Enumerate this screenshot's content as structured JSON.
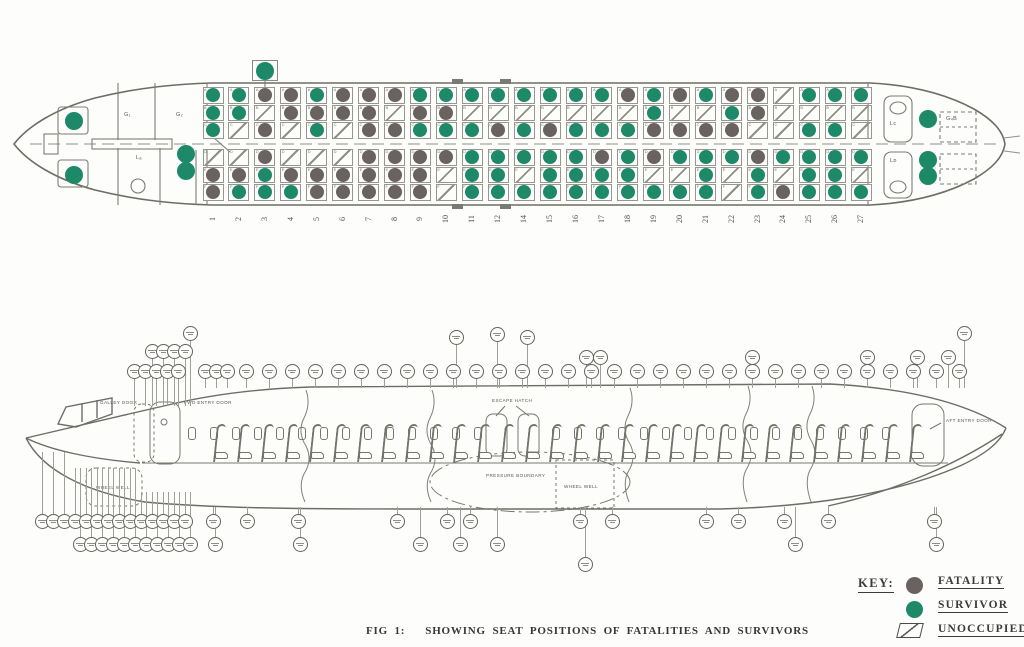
{
  "figure": {
    "label": "FIG 1:",
    "caption": "SHOWING SEAT POSITIONS OF FATALITIES AND SURVIVORS"
  },
  "key": {
    "heading": "KEY:",
    "items": [
      {
        "id": "fatality",
        "label": "FATALITY",
        "shape": "circle",
        "color": "#6a6261"
      },
      {
        "id": "survivor",
        "label": "SURVIVOR",
        "shape": "circle",
        "color": "#1e8968"
      },
      {
        "id": "unoccupied",
        "label": "UNOCCUPIED",
        "shape": "hatched-square",
        "color": "#5a5a5a"
      }
    ]
  },
  "plan_view": {
    "legend_states": {
      "S": "survivor",
      "F": "fatality",
      "U": "unoccupied"
    },
    "seat_letters": {
      "top": [
        "A",
        "B",
        "C"
      ],
      "bottom": [
        "D",
        "E",
        "F"
      ]
    },
    "cabin_labels": {
      "galley_1": "G₁",
      "galley_2": "G₂",
      "fwd_lavatory": "Lₐ",
      "closet": "C",
      "aft_lavatory_left": "Lᴄ",
      "aft_lavatory_right": "Lᴅ",
      "aft_galley": "G₄B"
    },
    "rows": [
      {
        "n": "1",
        "top": "SSS",
        "bottom": "UFF"
      },
      {
        "n": "2",
        "top": "SSU",
        "bottom": "UFS"
      },
      {
        "n": "3",
        "top": "FUF",
        "bottom": "FSS"
      },
      {
        "n": "4",
        "top": "FFU",
        "bottom": "UFS"
      },
      {
        "n": "5",
        "top": "SFS",
        "bottom": "UFF"
      },
      {
        "n": "6",
        "top": "FFU",
        "bottom": "UFF"
      },
      {
        "n": "7",
        "top": "FFF",
        "bottom": "FFF"
      },
      {
        "n": "8",
        "top": "FUF",
        "bottom": "FFF"
      },
      {
        "n": "9",
        "top": "SFS",
        "bottom": "FFF"
      },
      {
        "n": "10",
        "top": "SFS",
        "bottom": "FUU"
      },
      {
        "n": "11",
        "top": "SUS",
        "bottom": "SSS"
      },
      {
        "n": "12",
        "top": "SUF",
        "bottom": "SSS"
      },
      {
        "n": "14",
        "top": "SUS",
        "bottom": "SUS"
      },
      {
        "n": "15",
        "top": "SUF",
        "bottom": "SSS"
      },
      {
        "n": "16",
        "top": "SUS",
        "bottom": "SSS"
      },
      {
        "n": "17",
        "top": "SUS",
        "bottom": "FSS"
      },
      {
        "n": "18",
        "top": "FUS",
        "bottom": "SSS"
      },
      {
        "n": "19",
        "top": "SSF",
        "bottom": "FUS"
      },
      {
        "n": "20",
        "top": "FUF",
        "bottom": "SUS"
      },
      {
        "n": "21",
        "top": "SUF",
        "bottom": "SSS"
      },
      {
        "n": "22",
        "top": "FSF",
        "bottom": "SUU"
      },
      {
        "n": "23",
        "top": "FFU",
        "bottom": "FSS"
      },
      {
        "n": "24",
        "top": "UUU",
        "bottom": "SUF"
      },
      {
        "n": "25",
        "top": "SUS",
        "bottom": "SSS"
      },
      {
        "n": "26",
        "top": "SUS",
        "bottom": "SSS"
      },
      {
        "n": "27",
        "top": "SUU",
        "bottom": "SUS"
      }
    ],
    "jumpseats": [
      {
        "name": "cockpit-captain",
        "state": "S",
        "x": 74,
        "y": 121
      },
      {
        "name": "cockpit-first-officer",
        "state": "S",
        "x": 74,
        "y": 175
      },
      {
        "name": "fwd-jumpseat-1",
        "state": "S",
        "x": 186,
        "y": 154
      },
      {
        "name": "fwd-jumpseat-2",
        "state": "S",
        "x": 186,
        "y": 171
      },
      {
        "name": "aft-jumpseat-left",
        "state": "S",
        "x": 928,
        "y": 119
      },
      {
        "name": "aft-jumpseat-right-1",
        "state": "S",
        "x": 928,
        "y": 160
      },
      {
        "name": "aft-jumpseat-right-2",
        "state": "S",
        "x": 928,
        "y": 176
      }
    ],
    "annotation_seat": {
      "row": "3",
      "side": "top",
      "state": "S"
    }
  },
  "side_view": {
    "labels": {
      "galley_door": "GALLEY DOOR",
      "fwd_entry_door": "FWD ENTRY DOOR",
      "escape_hatch": "ESCAPE HATCH",
      "pressure_boundary": "PRESSURE BOUNDARY",
      "wheel_well_fwd": "WHEEL WELL",
      "wheel_well_mid": "WHEEL WELL",
      "aft_entry_door": "AFT ENTRY DOOR"
    },
    "callouts": {
      "note": "station reference circles (text illegible in source scan)",
      "top_main_y": 364,
      "top_main_x": [
        134,
        145,
        156,
        167,
        178,
        205,
        216,
        227,
        246,
        269,
        292,
        315,
        338,
        361,
        384,
        407,
        430,
        453,
        476,
        499,
        522,
        545,
        568,
        591,
        614,
        637,
        660,
        683,
        706,
        729,
        752,
        775,
        798,
        821,
        844,
        867,
        890,
        913,
        936,
        959
      ],
      "top_high": [
        {
          "x": 152,
          "y": 344
        },
        {
          "x": 163,
          "y": 344
        },
        {
          "x": 174,
          "y": 344
        },
        {
          "x": 185,
          "y": 344
        },
        {
          "x": 190,
          "y": 326
        },
        {
          "x": 456,
          "y": 330
        },
        {
          "x": 497,
          "y": 327
        },
        {
          "x": 527,
          "y": 330
        },
        {
          "x": 586,
          "y": 350
        },
        {
          "x": 600,
          "y": 350
        },
        {
          "x": 752,
          "y": 350
        },
        {
          "x": 867,
          "y": 350
        },
        {
          "x": 917,
          "y": 350
        },
        {
          "x": 948,
          "y": 350
        },
        {
          "x": 964,
          "y": 326
        }
      ],
      "bottom_tier1_y": 514,
      "bottom_tier1_x": [
        42,
        53,
        64,
        75,
        86,
        97,
        108,
        119,
        130,
        141,
        152,
        163,
        174,
        185,
        213,
        247,
        298,
        397,
        447,
        470,
        580,
        612,
        706,
        738,
        784,
        828,
        934
      ],
      "bottom_tier2_y": 537,
      "bottom_tier2_x": [
        80,
        91,
        102,
        113,
        124,
        135,
        146,
        157,
        168,
        179,
        190,
        215,
        300,
        420,
        460,
        497,
        795,
        936
      ],
      "bottom_low": [
        {
          "x": 585,
          "y": 557
        }
      ]
    }
  }
}
